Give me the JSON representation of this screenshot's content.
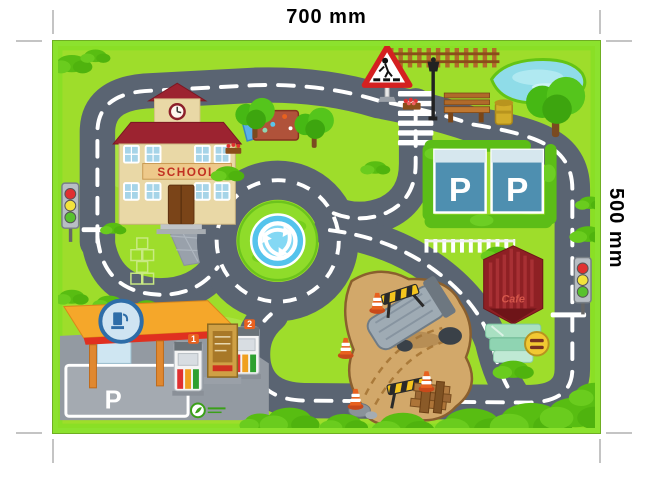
{
  "annotations": {
    "width_label": "700 mm",
    "height_label": "500 mm"
  },
  "mat": {
    "school_sign": "SCHOOL",
    "cafe_sign": "Cafe",
    "parking": {
      "spot_left": "P",
      "spot_right": "P"
    },
    "gas_station": {
      "pump_left_number": "1",
      "pump_right_number": "2",
      "ground_marking": "P"
    }
  },
  "colors": {
    "grass": "#9edd2b",
    "road": "#5a6472",
    "road_marking": "#ffffff",
    "mat_border": "#8ce22e",
    "parking_blue": "#4e8fb0",
    "cafe_awning": "#8e2024",
    "canopy_orange": "#f5a72a",
    "dirt": "#d2a86a",
    "pond_blue": "#8fdce8"
  }
}
